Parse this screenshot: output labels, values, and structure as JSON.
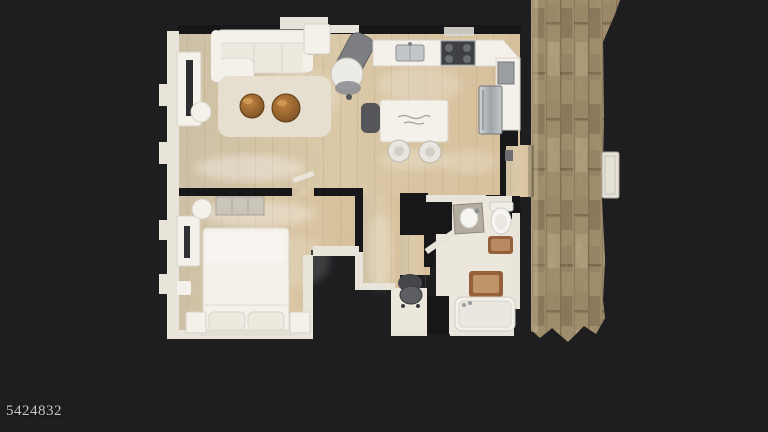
{
  "watermark": {
    "text": "5424832"
  },
  "colors": {
    "background": "#1e1e21",
    "floor_wood": "#d8c6a6",
    "floor_wood_light": "#e9ddc2",
    "floor_bath": "#ece7dc",
    "wall_dark": "#17171a",
    "wall_light": "#e8e4da",
    "furniture_white": "#f3f1ea",
    "rug": "#eae3d3",
    "coffee_table_wood": "#8d5c2a",
    "stainless": "#b6b9bd",
    "hall_carpet_base": "#a2906e",
    "hall_carpet_dark": "#5c4d38",
    "hall_carpet_light": "#c9b995",
    "bath_mat": "#95613a",
    "chair_gray": "#8e9093",
    "watermark_color": "#d8d8d8"
  }
}
